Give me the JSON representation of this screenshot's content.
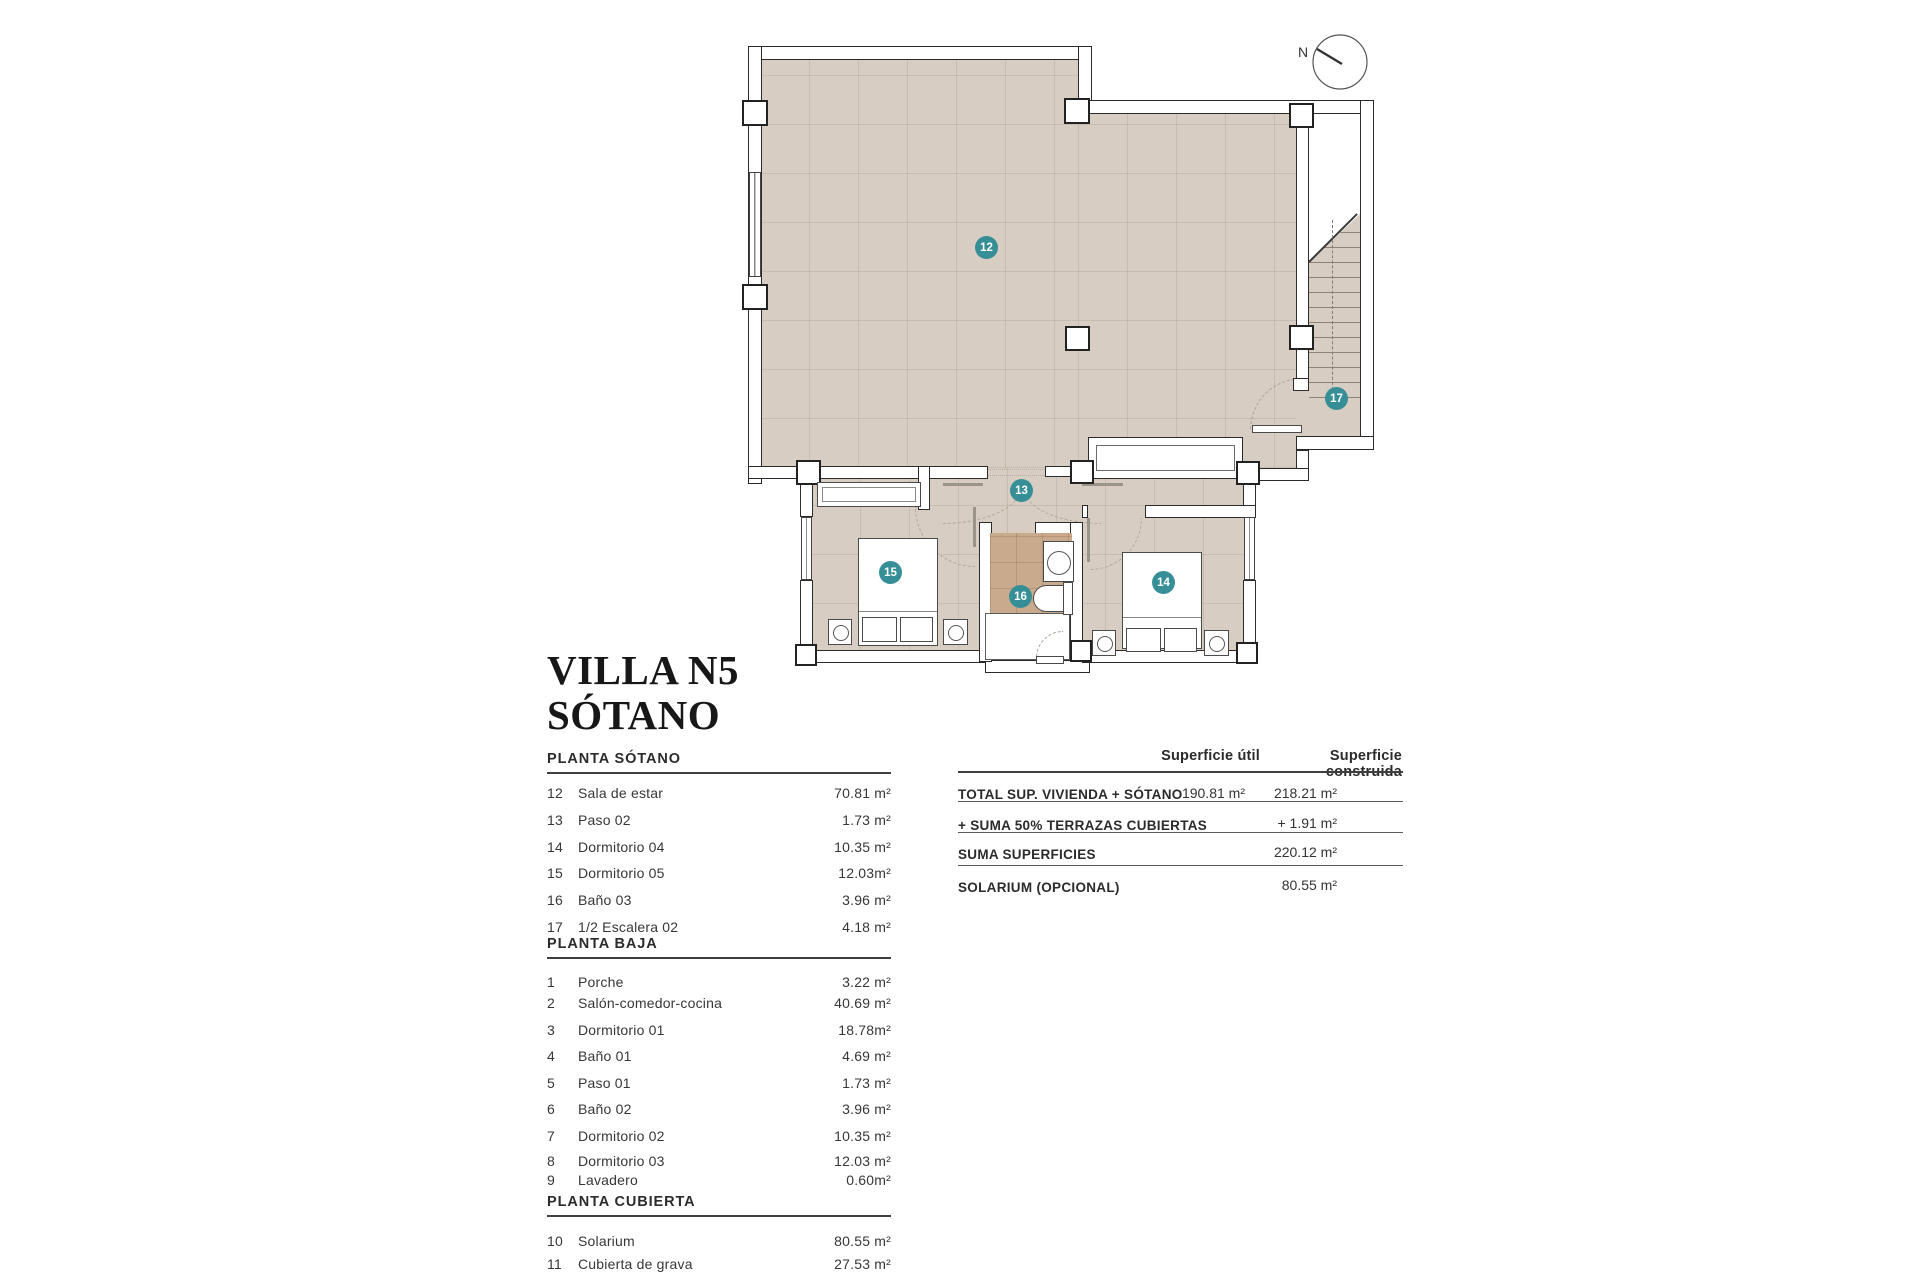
{
  "title": {
    "line1": "VILLA N5",
    "line2": "SÓTANO"
  },
  "compass": {
    "label": "N"
  },
  "plan": {
    "badges": [
      "12",
      "13",
      "14",
      "15",
      "16",
      "17"
    ]
  },
  "sections": [
    {
      "header": "PLANTA SÓTANO",
      "rows": [
        {
          "num": "12",
          "name": "Sala de estar",
          "area": "70.81 m²"
        },
        {
          "num": "13",
          "name": "Paso 02",
          "area": "1.73 m²"
        },
        {
          "num": "14",
          "name": "Dormitorio 04",
          "area": "10.35 m²"
        },
        {
          "num": "15",
          "name": "Dormitorio 05",
          "area": "12.03m²"
        },
        {
          "num": "16",
          "name": "Baño 03",
          "area": "3.96 m²"
        },
        {
          "num": "17",
          "name": "1/2 Escalera 02",
          "area": "4.18 m²"
        }
      ]
    },
    {
      "header": "PLANTA BAJA",
      "rows": [
        {
          "num": "1",
          "name": "Porche",
          "area": "3.22 m²"
        },
        {
          "num": "2",
          "name": "Salón-comedor-cocina",
          "area": "40.69 m²"
        },
        {
          "num": "3",
          "name": "Dormitorio 01",
          "area": "18.78m²"
        },
        {
          "num": "4",
          "name": "Baño 01",
          "area": "4.69 m²"
        },
        {
          "num": "5",
          "name": "Paso 01",
          "area": "1.73 m²"
        },
        {
          "num": "6",
          "name": "Baño 02",
          "area": "3.96 m²"
        },
        {
          "num": "7",
          "name": "Dormitorio 02",
          "area": "10.35 m²"
        },
        {
          "num": "8",
          "name": "Dormitorio 03",
          "area": "12.03 m²"
        },
        {
          "num": "9",
          "name": "Lavadero",
          "area": "0.60m²"
        }
      ]
    },
    {
      "header": "PLANTA CUBIERTA",
      "rows": [
        {
          "num": "10",
          "name": "Solarium",
          "area": "80.55 m²"
        },
        {
          "num": "11",
          "name": "Cubierta de grava",
          "area": "27.53 m²"
        }
      ]
    }
  ],
  "summary": {
    "col_util": "Superficie útil",
    "col_cons": "Superficie construida",
    "rows": [
      {
        "label": "TOTAL SUP. VIVIENDA + SÓTANO",
        "util": "190.81 m²",
        "cons": "218.21 m²"
      },
      {
        "label": "+ SUMA 50% TERRAZAS CUBIERTAS",
        "util": "",
        "cons": "+ 1.91 m²"
      },
      {
        "label": "SUMA SUPERFICIES",
        "util": "",
        "cons": "220.12 m²"
      },
      {
        "label": "SOLARIUM (OPCIONAL)",
        "util": "",
        "cons": "80.55 m²"
      }
    ]
  },
  "colors": {
    "badge_teal": "#368f96",
    "floor_beige": "#d7cdc2",
    "floor_bath": "#c9aa8d",
    "wall_line": "#2b2b2b"
  }
}
